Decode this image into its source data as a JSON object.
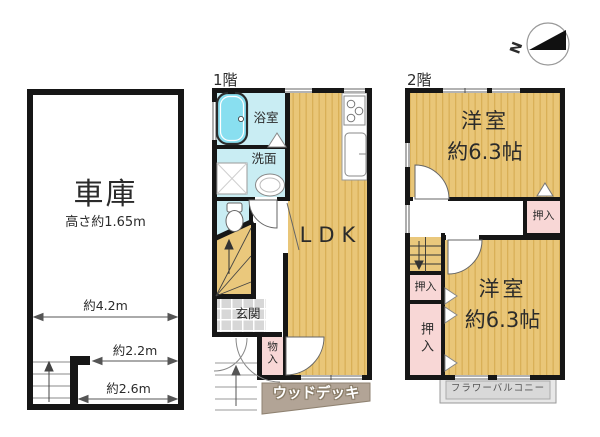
{
  "compass": {
    "north_label": "N"
  },
  "garage": {
    "label": "車庫",
    "height_note": "高さ約1.65m",
    "dim_width": "約4.2m",
    "dim_inner_upper": "約2.2m",
    "dim_inner_lower": "約2.6m"
  },
  "floor1": {
    "title": "1階",
    "bathroom": "浴室",
    "washroom": "洗面",
    "living": "LDK",
    "entrance": "玄関",
    "storage": "物入",
    "wood_deck": "ウッドデッキ"
  },
  "floor2": {
    "title": "2階",
    "upper_room_name": "洋室",
    "upper_room_size": "約6.3帖",
    "upper_closet": "押入",
    "middle_closet": "押入",
    "lower_closet": "押入",
    "lower_room_name": "洋室",
    "lower_room_size": "約6.3帖",
    "balcony": "フラワーバルコニー"
  },
  "colors": {
    "wall": "#161616",
    "room_floor": "#e9c678",
    "floor_stripe": "#d9b057",
    "wet_area": "#c9edf3",
    "bathtub": "#89dff0",
    "closet_pink": "#f8d7d6",
    "deck": "#b2a496",
    "balcony_gray": "#d9d9d9"
  }
}
